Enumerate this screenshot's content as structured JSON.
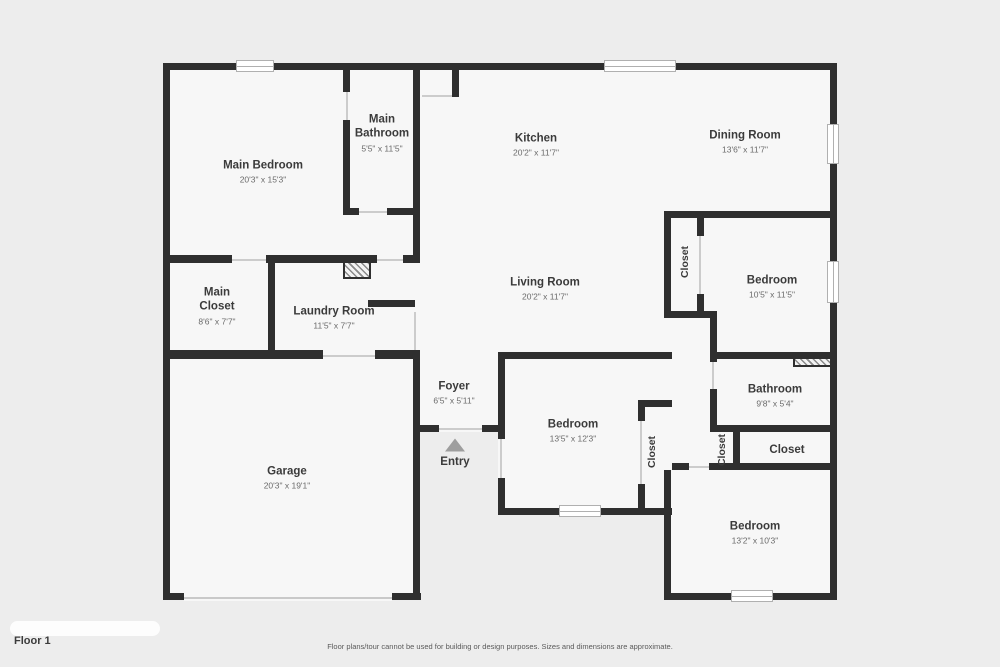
{
  "rooms": {
    "main_bedroom": {
      "name": "Main Bedroom",
      "dims": "20'3\" x 15'3\""
    },
    "main_bathroom": {
      "name": "Main Bathroom",
      "dims": "5'5\" x 11'5\""
    },
    "kitchen": {
      "name": "Kitchen",
      "dims": "20'2\" x 11'7\""
    },
    "dining_room": {
      "name": "Dining Room",
      "dims": "13'6\" x 11'7\""
    },
    "living_room": {
      "name": "Living Room",
      "dims": "20'2\" x 11'7\""
    },
    "bedroom_ne": {
      "name": "Bedroom",
      "dims": "10'5\" x 11'5\""
    },
    "main_closet": {
      "name": "Main Closet",
      "dims": "8'6\" x 7'7\""
    },
    "laundry_room": {
      "name": "Laundry Room",
      "dims": "11'5\" x 7'7\""
    },
    "foyer": {
      "name": "Foyer",
      "dims": "6'5\" x 5'11\""
    },
    "garage": {
      "name": "Garage",
      "dims": "20'3\" x 19'1\""
    },
    "bedroom_mid": {
      "name": "Bedroom",
      "dims": "13'5\" x 12'3\""
    },
    "bathroom": {
      "name": "Bathroom",
      "dims": "9'8\" x 5'4\""
    },
    "closet_se": {
      "name": "Closet"
    },
    "bedroom_s": {
      "name": "Bedroom",
      "dims": "13'2\" x 10'3\""
    }
  },
  "closet_labels": {
    "ne": "Closet",
    "mid": "Closet",
    "bath": "Closet"
  },
  "entry_label": "Entry",
  "footer": {
    "floor_label": "Floor 1",
    "disclaimer": "Floor plans/tour cannot be used for building or design purposes. Sizes and dimensions are approximate."
  },
  "colors": {
    "wall": "#2f2f2f",
    "floor": "#f7f7f7",
    "background": "#ededed",
    "door_line": "#cccccc",
    "window_border": "#b0b0b0",
    "entry_arrow": "#9e9e9e"
  }
}
